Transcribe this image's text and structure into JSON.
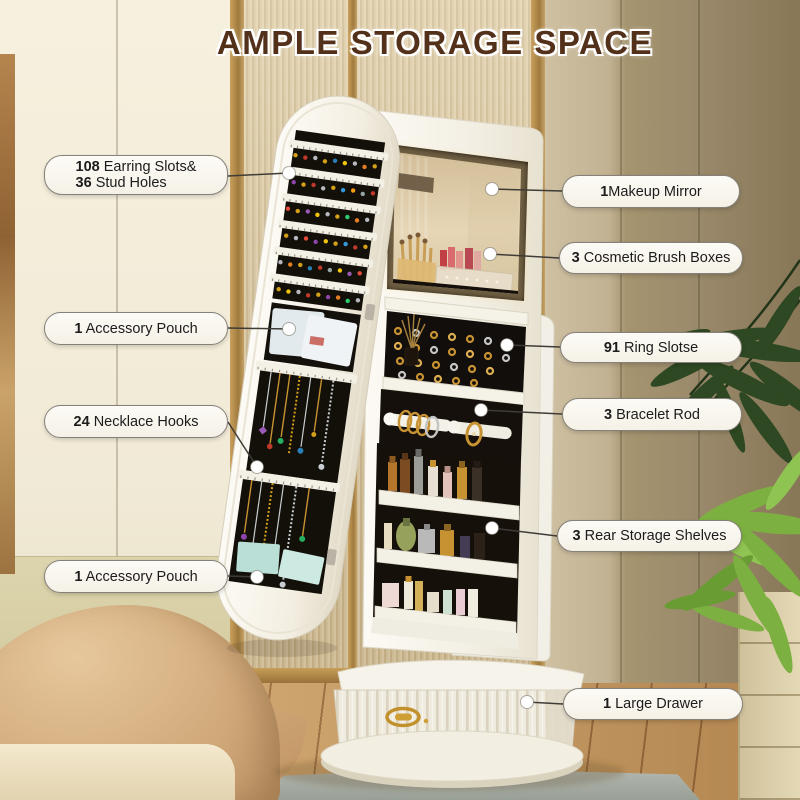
{
  "title": "AMPLE STORAGE SPACE",
  "colors": {
    "title_brown": "#53301a",
    "led_glow": "#ffe4a6",
    "gold_hardware": "#c79231",
    "wall_taupe": "#9a8a6b",
    "wood_floor": "#caa06a",
    "cabinet_white": "#f6f3ea",
    "felt_black": "#14100d",
    "plant_green": "#7cb041"
  },
  "callouts": [
    {
      "id": "earring-slots",
      "lines": [
        {
          "num": "108",
          "text": " Earring Slots&"
        },
        {
          "num": "36",
          "text": " Stud Holes"
        }
      ]
    },
    {
      "id": "accessory-pouch-top",
      "lines": [
        {
          "num": "1",
          "text": " Accessory Pouch"
        }
      ]
    },
    {
      "id": "necklace-hooks",
      "lines": [
        {
          "num": "24",
          "text": " Necklace Hooks"
        }
      ]
    },
    {
      "id": "accessory-pouch-bottom",
      "lines": [
        {
          "num": "1",
          "text": " Accessory Pouch"
        }
      ]
    },
    {
      "id": "makeup-mirror",
      "lines": [
        {
          "num": "1",
          "text": "Makeup Mirror"
        }
      ]
    },
    {
      "id": "cosmetic-brush-boxes",
      "lines": [
        {
          "num": "3",
          "text": " Cosmetic Brush Boxes"
        }
      ]
    },
    {
      "id": "ring-slots",
      "lines": [
        {
          "num": "91",
          "text": " Ring Slotse"
        }
      ]
    },
    {
      "id": "bracelet-rod",
      "lines": [
        {
          "num": "3",
          "text": " Bracelet Rod"
        }
      ]
    },
    {
      "id": "rear-storage-shelves",
      "lines": [
        {
          "num": "3",
          "text": " Rear Storage Shelves"
        }
      ]
    },
    {
      "id": "large-drawer",
      "lines": [
        {
          "num": "1",
          "text": " Large Drawer"
        }
      ]
    }
  ]
}
